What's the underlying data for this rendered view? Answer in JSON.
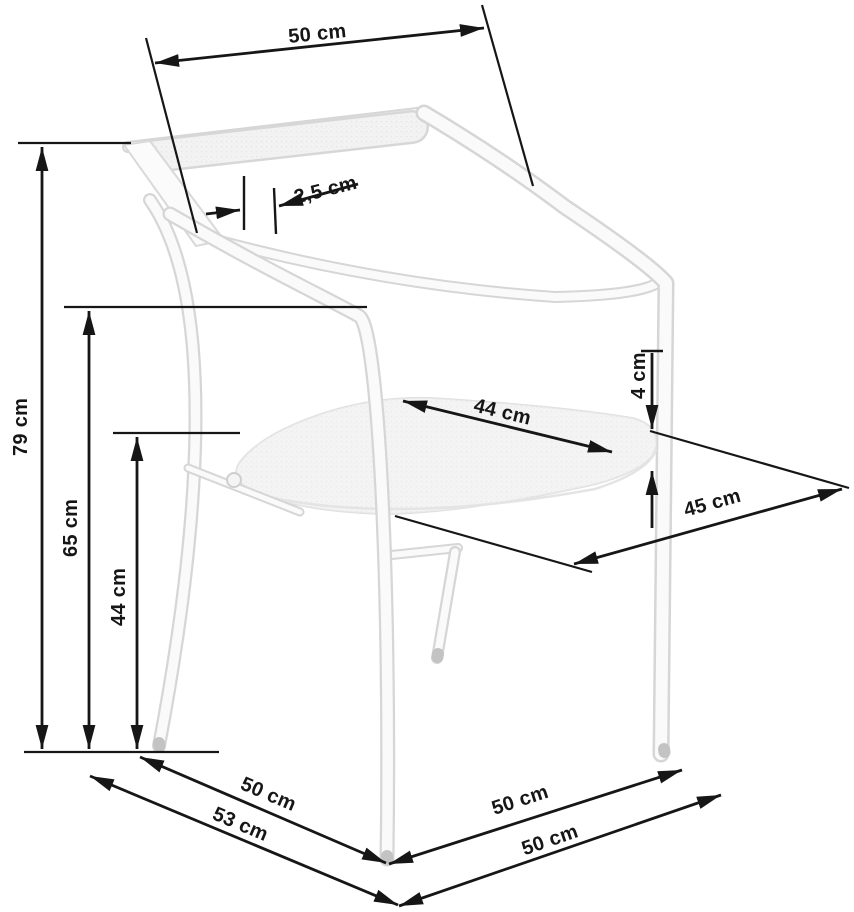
{
  "diagram": {
    "subject": "chair-dimension-drawing",
    "unit": "cm",
    "dimensions": {
      "backrest_width": "50 cm",
      "backrest_bar_offset": "2,5 cm",
      "total_height": "79 cm",
      "armrest_height": "65 cm",
      "seat_height": "44 cm",
      "seat_width": "44 cm",
      "seat_cushion_thickness": "4 cm",
      "seat_depth": "45 cm",
      "base_side_depth": "50 cm",
      "base_overall_depth": "53 cm",
      "base_right_depth": "50 cm",
      "base_front_width": "50 cm"
    },
    "colors": {
      "background": "#ffffff",
      "dimension_lines": "#161616",
      "chair_outline": "#d6d6d6",
      "chair_fill": "#f5f5f5"
    }
  }
}
